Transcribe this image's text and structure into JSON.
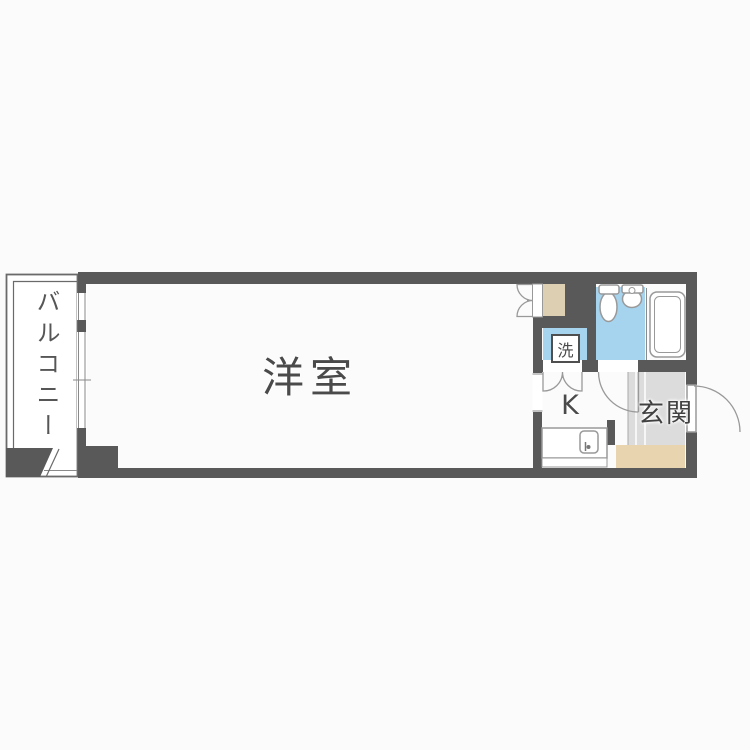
{
  "rooms": {
    "living": {
      "label": "洋室"
    },
    "balcony": {
      "label": "バルコニー"
    },
    "kitchen": {
      "label": "K"
    },
    "entrance": {
      "label": "玄関"
    },
    "laundry": {
      "label": "洗"
    }
  },
  "colors": {
    "wall": "#595959",
    "water": "#a6d4ee",
    "closet": "#ddcfb1",
    "corridor": "#e8d5b0",
    "tile": "#dcdcdc",
    "line": "#999999",
    "text": "#4a4a4a",
    "page": "#fbfbfb"
  }
}
